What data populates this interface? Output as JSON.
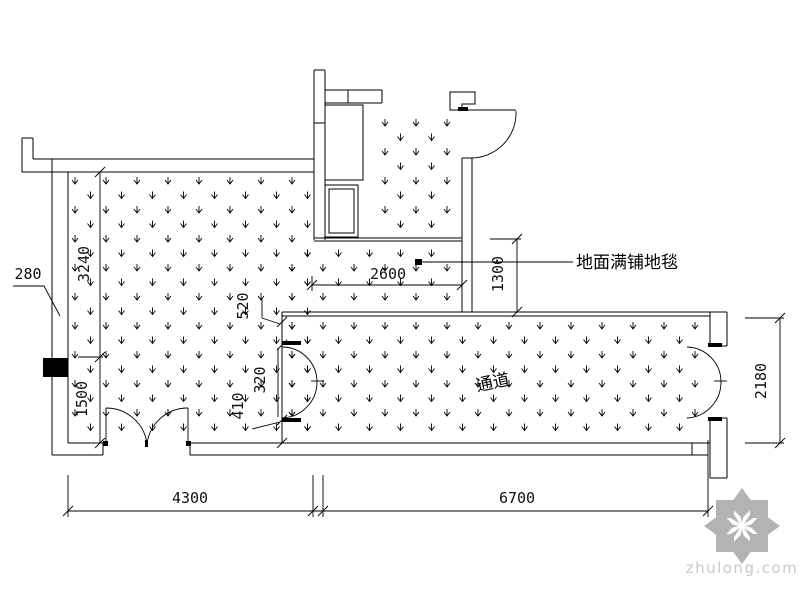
{
  "drawing": {
    "dimensions": {
      "d280": "280",
      "d3240": "3240",
      "d1500": "1500",
      "d4300": "4300",
      "d6700": "6700",
      "d2600": "2600",
      "d1300": "1300",
      "d2180": "2180",
      "d520": "520",
      "d320": "320",
      "d410": "410"
    },
    "annotations": {
      "carpet_note": "地面满铺地毯",
      "corridor_label": "通道"
    },
    "colors": {
      "line": "#000000",
      "watermark": "#b3b3b3",
      "watermark_text": "#c9c9c9",
      "background": "#ffffff"
    }
  },
  "watermark": {
    "text": "zhulong.com"
  }
}
